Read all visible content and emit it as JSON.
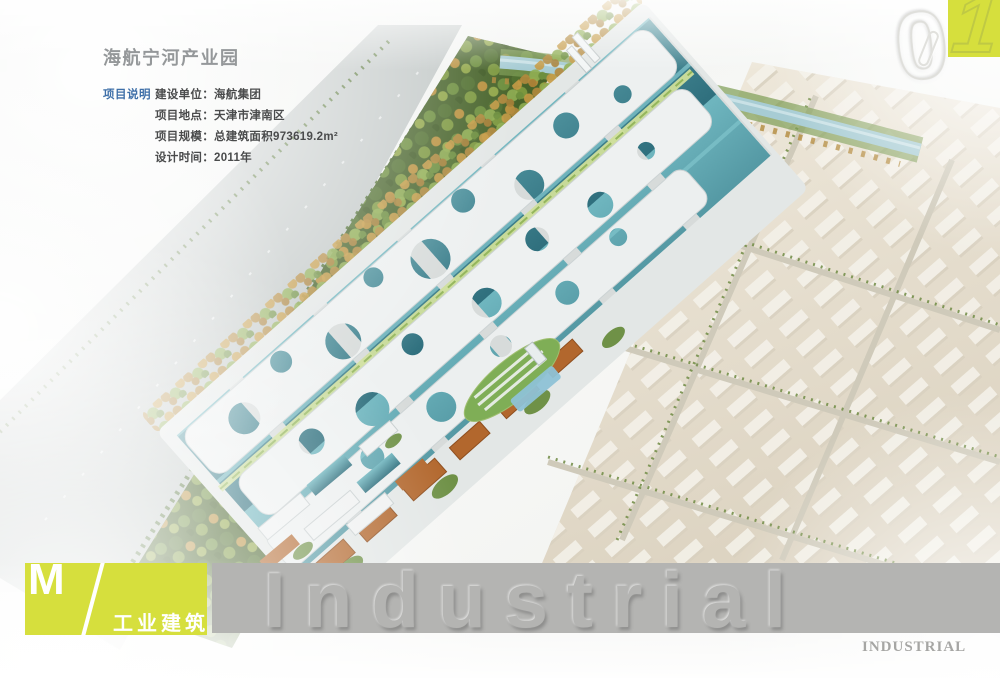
{
  "header": {
    "title": "海航宁河产业园",
    "section_label": "项目说明",
    "details": [
      "建设单位：海航集团",
      "项目地点：天津市津南区",
      "项目规模：总建筑面积973619.2m²",
      "设计时间：2011年"
    ]
  },
  "corner": {
    "digits": [
      "0",
      "1"
    ]
  },
  "banner": {
    "letter": "M",
    "category": "工业建筑"
  },
  "watermark": {
    "embossed": "Industrial",
    "caption": "INDUSTRIAL"
  },
  "colors": {
    "accent_lime": "#d6df3d",
    "bar_gray": "#b4b4b2",
    "label_blue": "#3e6fa8",
    "title_gray": "#95989a",
    "canopy_white": "#edf0f0",
    "glass_teal": "#3f8d9b",
    "roof_orange": "#b2672d",
    "forest_green": "#47632a",
    "warehouse_beige": "#e5ded0",
    "river_blue": "#a7ccd4"
  }
}
